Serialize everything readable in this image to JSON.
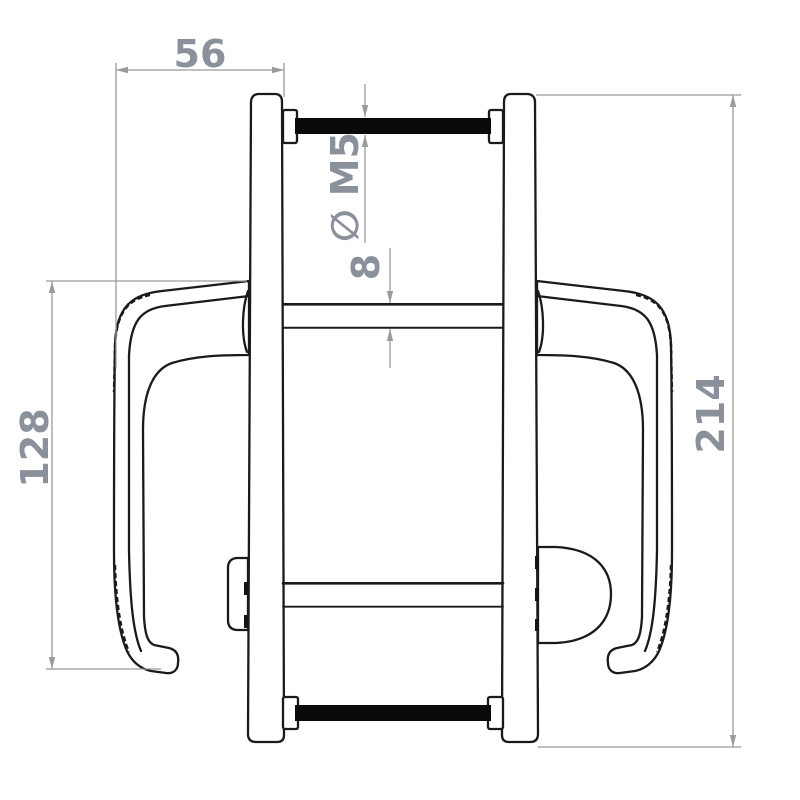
{
  "figure": {
    "dimensions": {
      "top_width": "56",
      "screw_thread": "∅ M5",
      "spindle_thickness": "8",
      "handle_height": "128",
      "overall_height": "214"
    },
    "colors": {
      "outline": "#1a1a1a",
      "dimension_lines": "#9a9a9a",
      "label_text": "#8b919a",
      "background": "#ffffff",
      "screw_fill": "#0a0a0a"
    }
  }
}
